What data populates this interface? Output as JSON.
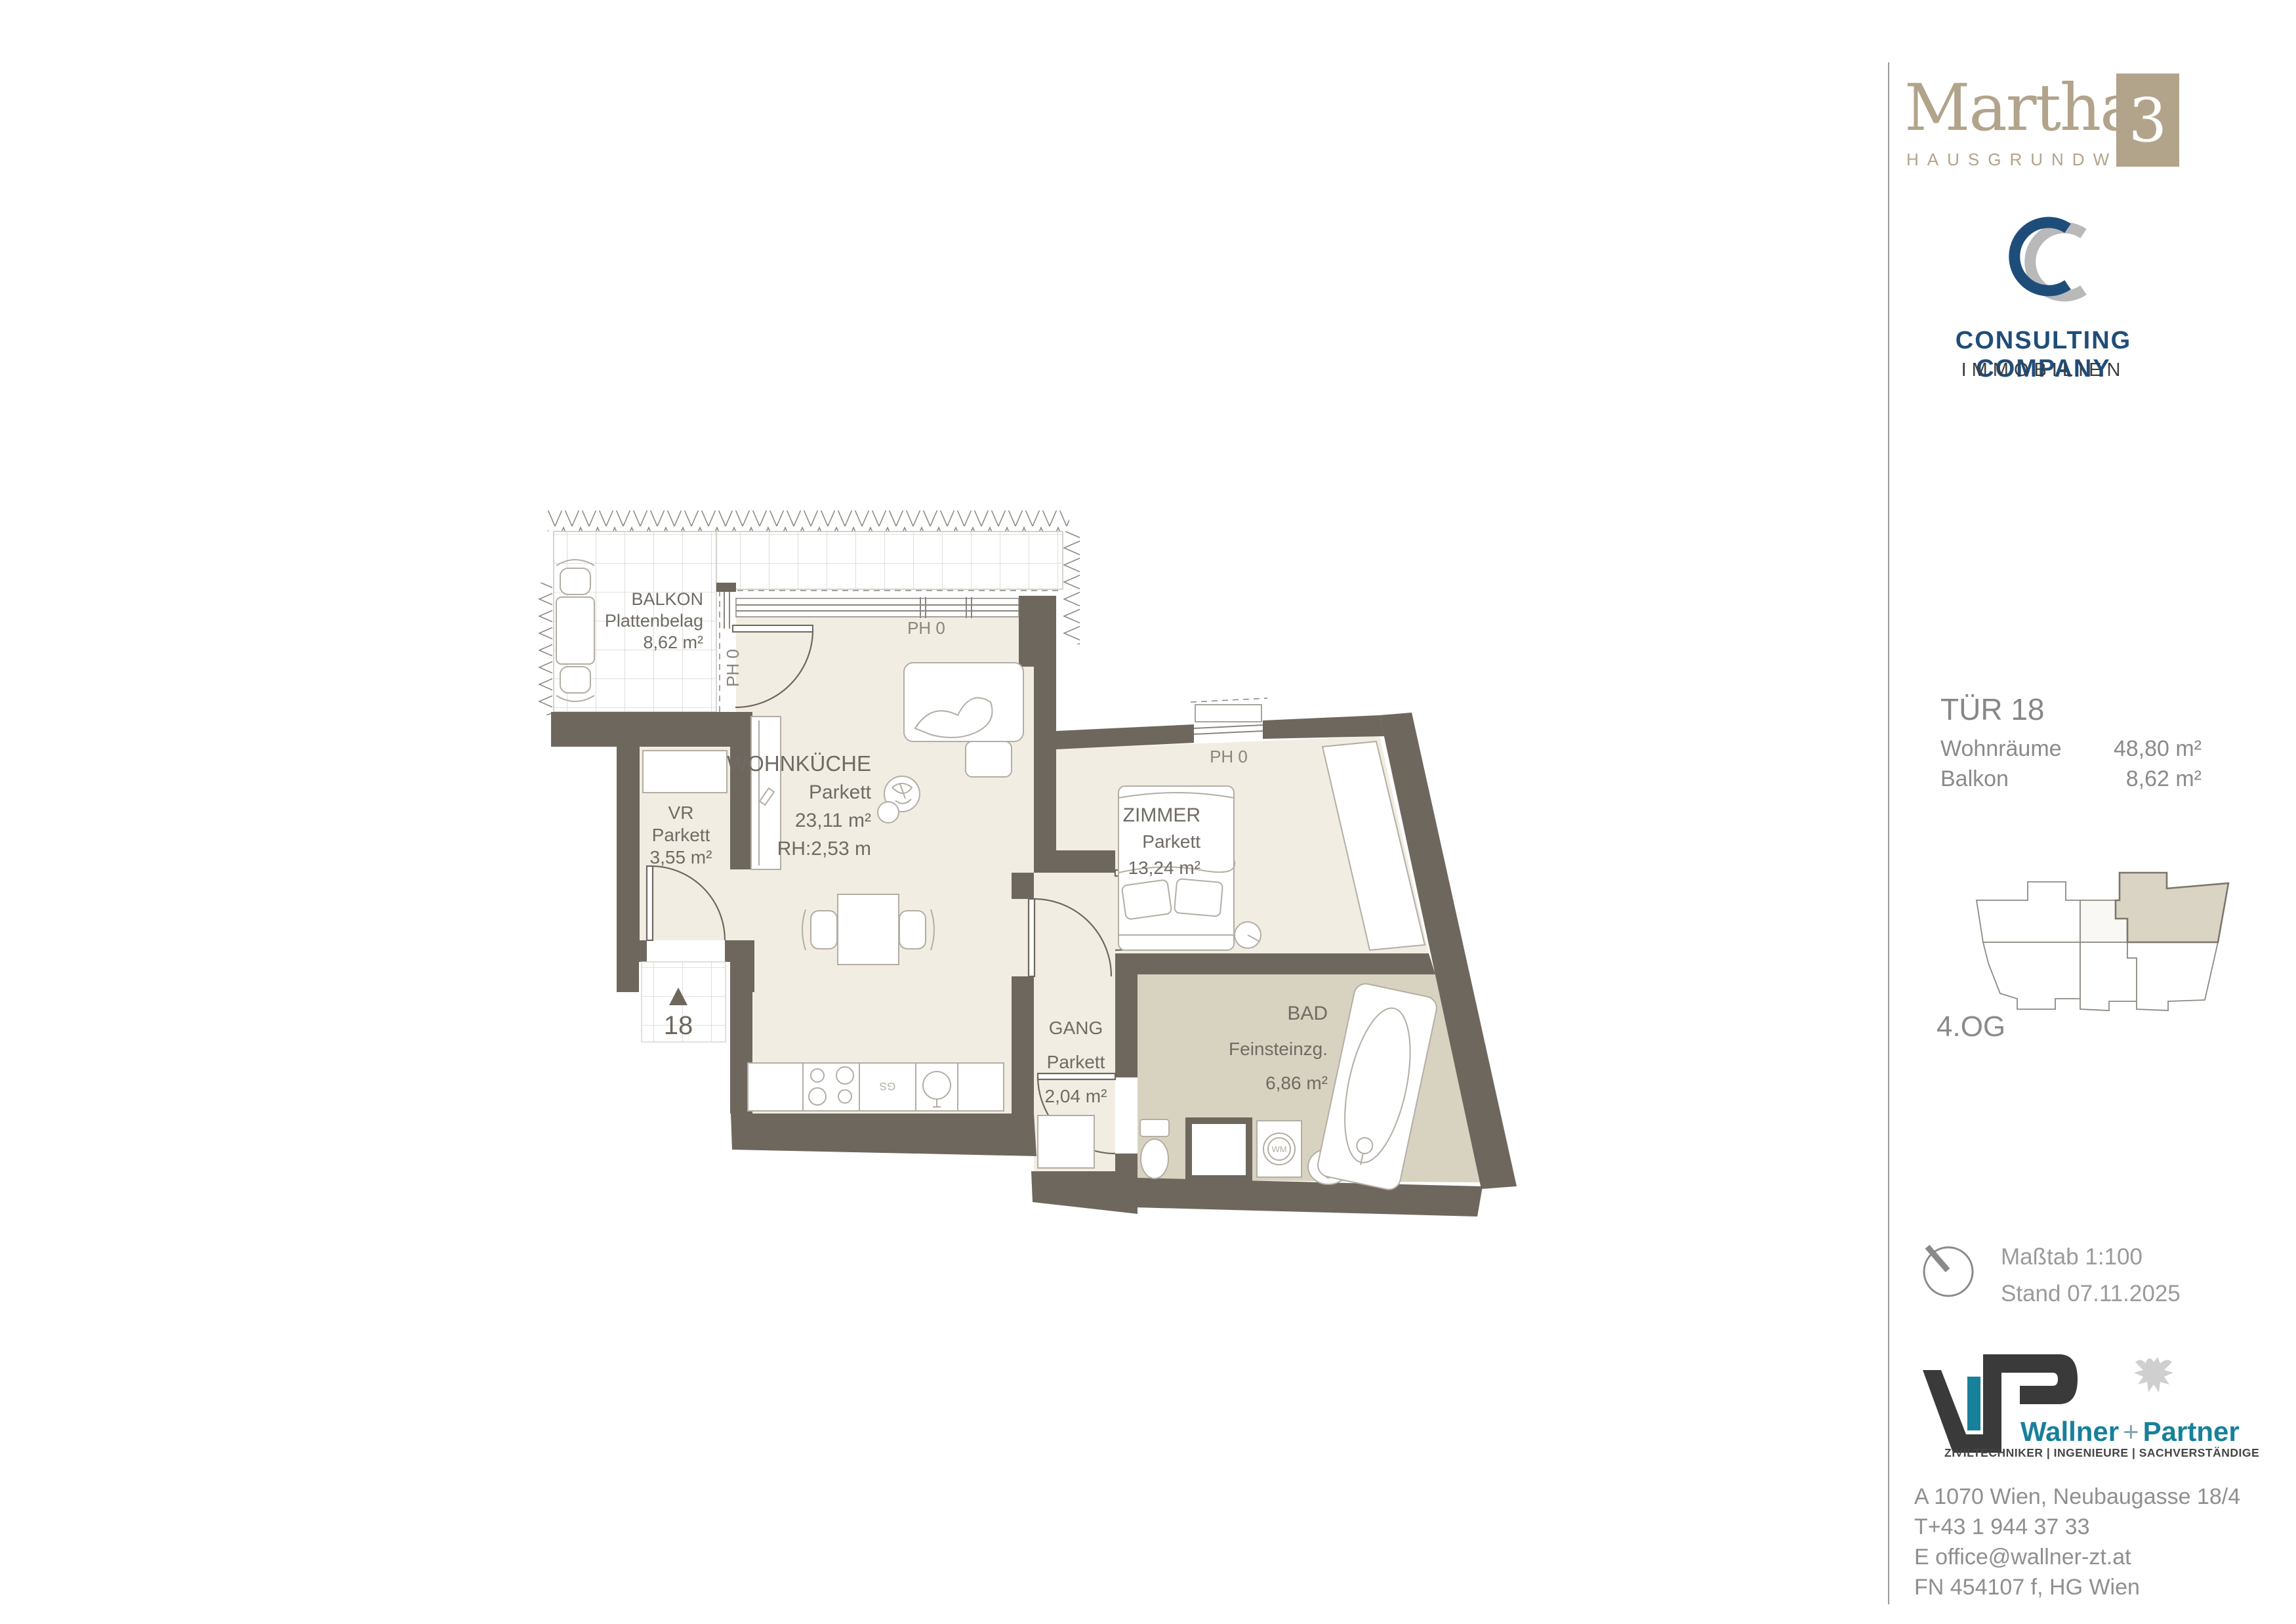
{
  "plan": {
    "rooms": {
      "balkon": {
        "name": "BALKON",
        "floor": "Plattenbelag",
        "area": "8,62 m²"
      },
      "wohnkueche": {
        "name": "WOHNKÜCHE",
        "floor": "Parkett",
        "area": "23,11 m²",
        "height": "RH:2,53 m"
      },
      "vr": {
        "name": "VR",
        "floor": "Parkett",
        "area": "3,55 m²"
      },
      "zimmer": {
        "name": "ZIMMER",
        "floor": "Parkett",
        "area": "13,24 m²"
      },
      "gang": {
        "name": "GANG",
        "floor": "Parkett",
        "area": "2,04 m²"
      },
      "bad": {
        "name": "BAD",
        "floor": "Feinsteinzg.",
        "area": "6,86 m²"
      }
    },
    "labels": {
      "ph0": "PH 0",
      "door_number": "18",
      "gs": "GS",
      "wm": "WM"
    }
  },
  "sidebar": {
    "project": {
      "name": "Martha",
      "number": "3",
      "subtitle": "HAUSGRUNDWEG"
    },
    "broker": {
      "line1": "CONSULTING COMPANY",
      "sub": "IMMOBILIEN"
    },
    "unit": {
      "title": "TÜR 18",
      "rows": [
        {
          "label": "Wohnräume",
          "value": "48,80 m²"
        },
        {
          "label": "Balkon",
          "value": "8,62 m²"
        }
      ]
    },
    "floor_label": "4.OG",
    "scale_line": "Maßtab 1:100",
    "date_line": "Stand 07.11.2025",
    "engineer": {
      "name_main": "Wallner",
      "name_plus": "+",
      "name_second": "Partner",
      "tagline": "ZIVILTECHNIKER | INGENIEURE | SACHVERSTÄNDIGE"
    },
    "address": {
      "line1": "A 1070 Wien, Neubaugasse 18/4",
      "line2": "T+43 1 944 37 33",
      "line3": "E office@wallner-zt.at",
      "line4": "FN 454107 f, HG Wien"
    }
  },
  "colors": {
    "wall": "#6e675e",
    "floor": "#f2ede3",
    "bad_floor": "#d8d3c0",
    "brand_beige": "#b2a38b",
    "brand_blue": "#1f4d7a",
    "brand_teal": "#17809b",
    "highlight_unit": "#d9d4c3"
  }
}
